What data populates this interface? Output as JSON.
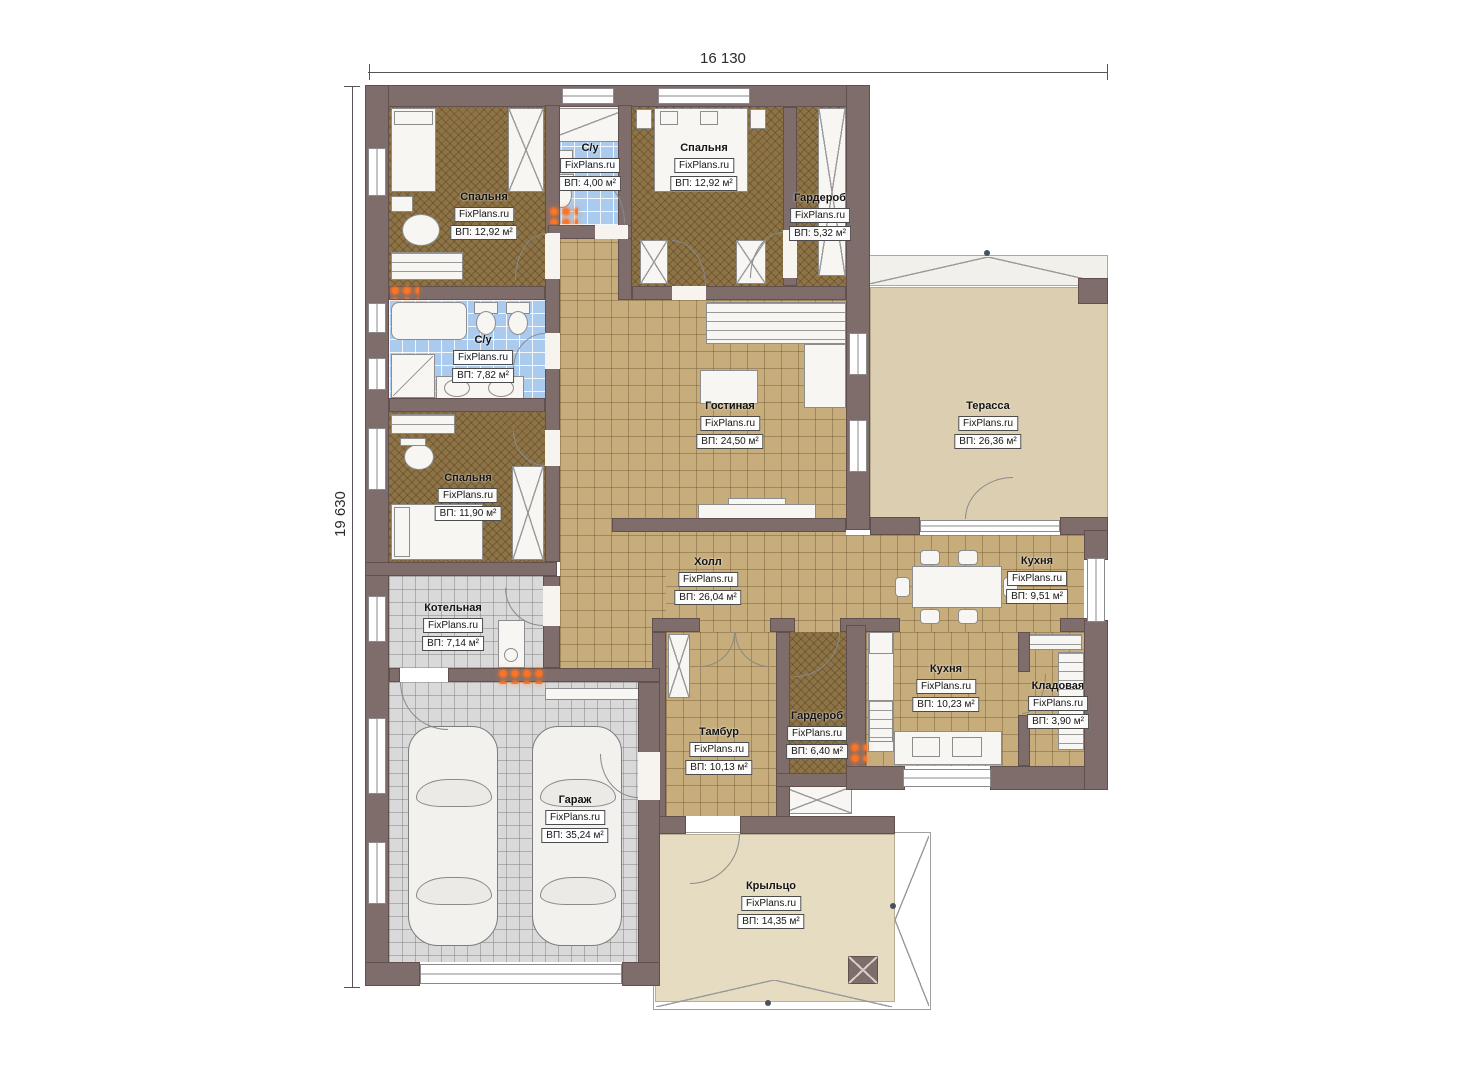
{
  "brand": "FixPlans.ru",
  "dimensions": {
    "width_label": "16 130",
    "height_label": "19 630"
  },
  "rooms": [
    {
      "key": "bedroom-1",
      "name": "Спальня",
      "brand": "FixPlans.ru",
      "area": "ВП: 12,92 м²"
    },
    {
      "key": "bathroom-small",
      "name": "С/у",
      "brand": "FixPlans.ru",
      "area": "ВП: 4,00 м²"
    },
    {
      "key": "bedroom-2",
      "name": "Спальня",
      "brand": "FixPlans.ru",
      "area": "ВП: 12,92 м²"
    },
    {
      "key": "wardrobe-1",
      "name": "Гардероб",
      "brand": "FixPlans.ru",
      "area": "ВП: 5,32 м²"
    },
    {
      "key": "bathroom-big",
      "name": "С/у",
      "brand": "FixPlans.ru",
      "area": "ВП: 7,82 м²"
    },
    {
      "key": "living-room",
      "name": "Гостиная",
      "brand": "FixPlans.ru",
      "area": "ВП: 24,50 м²"
    },
    {
      "key": "terrace",
      "name": "Терасса",
      "brand": "FixPlans.ru",
      "area": "ВП: 26,36 м²"
    },
    {
      "key": "bedroom-3",
      "name": "Спальня",
      "brand": "FixPlans.ru",
      "area": "ВП: 11,90 м²"
    },
    {
      "key": "hall",
      "name": "Холл",
      "brand": "FixPlans.ru",
      "area": "ВП: 26,04 м²"
    },
    {
      "key": "kitchen-dining",
      "name": "Кухня",
      "brand": "FixPlans.ru",
      "area": "ВП: 9,51 м²"
    },
    {
      "key": "boiler-room",
      "name": "Котельная",
      "brand": "FixPlans.ru",
      "area": "ВП: 7,14 м²"
    },
    {
      "key": "kitchen",
      "name": "Кухня",
      "brand": "FixPlans.ru",
      "area": "ВП: 10,23 м²"
    },
    {
      "key": "pantry",
      "name": "Кладовая",
      "brand": "FixPlans.ru",
      "area": "ВП: 3,90 м²"
    },
    {
      "key": "tambour",
      "name": "Тамбур",
      "brand": "FixPlans.ru",
      "area": "ВП: 10,13 м²"
    },
    {
      "key": "wardrobe-2",
      "name": "Гардероб",
      "brand": "FixPlans.ru",
      "area": "ВП: 6,40 м²"
    },
    {
      "key": "garage",
      "name": "Гараж",
      "brand": "FixPlans.ru",
      "area": "ВП: 35,24 м²"
    },
    {
      "key": "porch",
      "name": "Крыльцо",
      "brand": "FixPlans.ru",
      "area": "ВП: 14,35 м²"
    }
  ],
  "colors": {
    "wall": "#7e6d6b",
    "floor_tan": "#c7ad7c",
    "floor_brown": "#8d7346",
    "floor_blue": "#abcbee",
    "floor_gray": "#d9d9d9",
    "terrace": "#dccfb1",
    "porch": "#e6dcc2",
    "heater": "#ff7324"
  }
}
